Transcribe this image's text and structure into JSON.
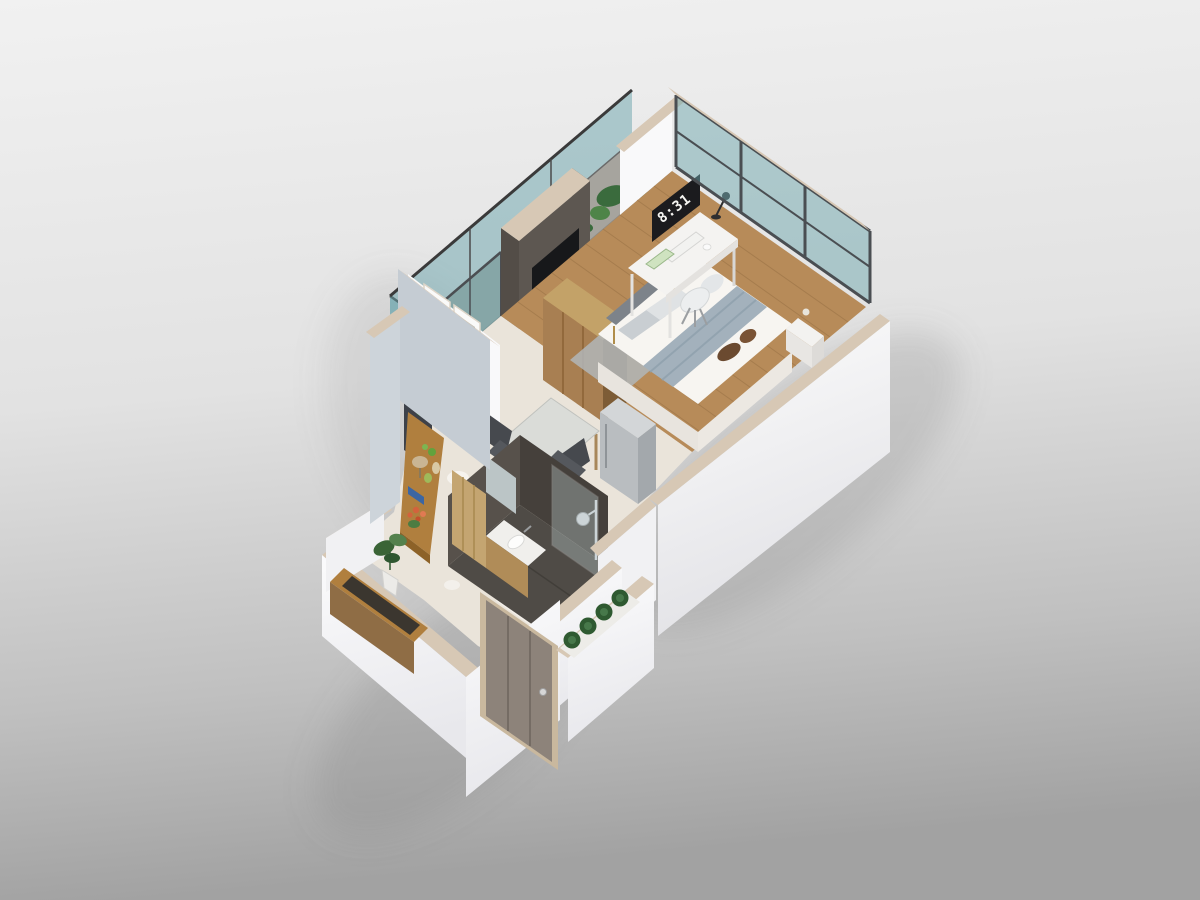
{
  "scene": {
    "clock_time": "8:31"
  },
  "palette": {
    "bg_top": "#f0f0f0",
    "bg_mid": "#dcdcdc",
    "bg_bottom": "#a4a4a4",
    "shadow": "#7a7a7a",
    "wall_white": "#f9f9fa",
    "wall_white_dim": "#f1f1f3",
    "wall_cap_tan": "#d7c8b5",
    "wall_blue_gray": "#c5ccd3",
    "glass_teal": "#6fa7ae",
    "glass_frame": "#4a4e52",
    "balcony_stone": "#a6a49e",
    "wood_floor": "#b78b59",
    "wood_plank_line": "#8a653c",
    "tile_light": "#eae4da",
    "tv_wall": "#5d5751",
    "tv_wall_side": "#4a433d",
    "tv_screen": "#17181a",
    "desk_white": "#f4f3f1",
    "clock_bg": "#1b1b1e",
    "clock_text": "#f5f5f2",
    "bed_white": "#f7f5f1",
    "bed_runner": "#a3b1bc",
    "pillow_gray": "#c9ced2",
    "cushion_brown": "#6b4a30",
    "bench_gray": "#7d838a",
    "rug_gray": "#b2b6b9",
    "wardrobe_wood": "#a87f52",
    "fridge_gray": "#b9bdc0",
    "chair_dark": "#55585d",
    "table_top": "#dadcd8",
    "shelf_wood": "#b07f3e",
    "panel_navy": "#3e4148",
    "plant_green": "#3a6b3d",
    "plant_dark": "#2f5730",
    "flower_orange": "#d2633c",
    "book_blue": "#3c66a3",
    "slate_floor": "#4f4b46",
    "slate_wall": "#57514b",
    "slate_wall_dark": "#45403b",
    "bath_door_wood": "#c4a571",
    "vanity_wood": "#b08c58",
    "chrome": "#c9ccce",
    "front_door_taupe": "#8d837a",
    "door_frame_tan": "#c9b89e",
    "planter_green": "#2f5a31"
  }
}
